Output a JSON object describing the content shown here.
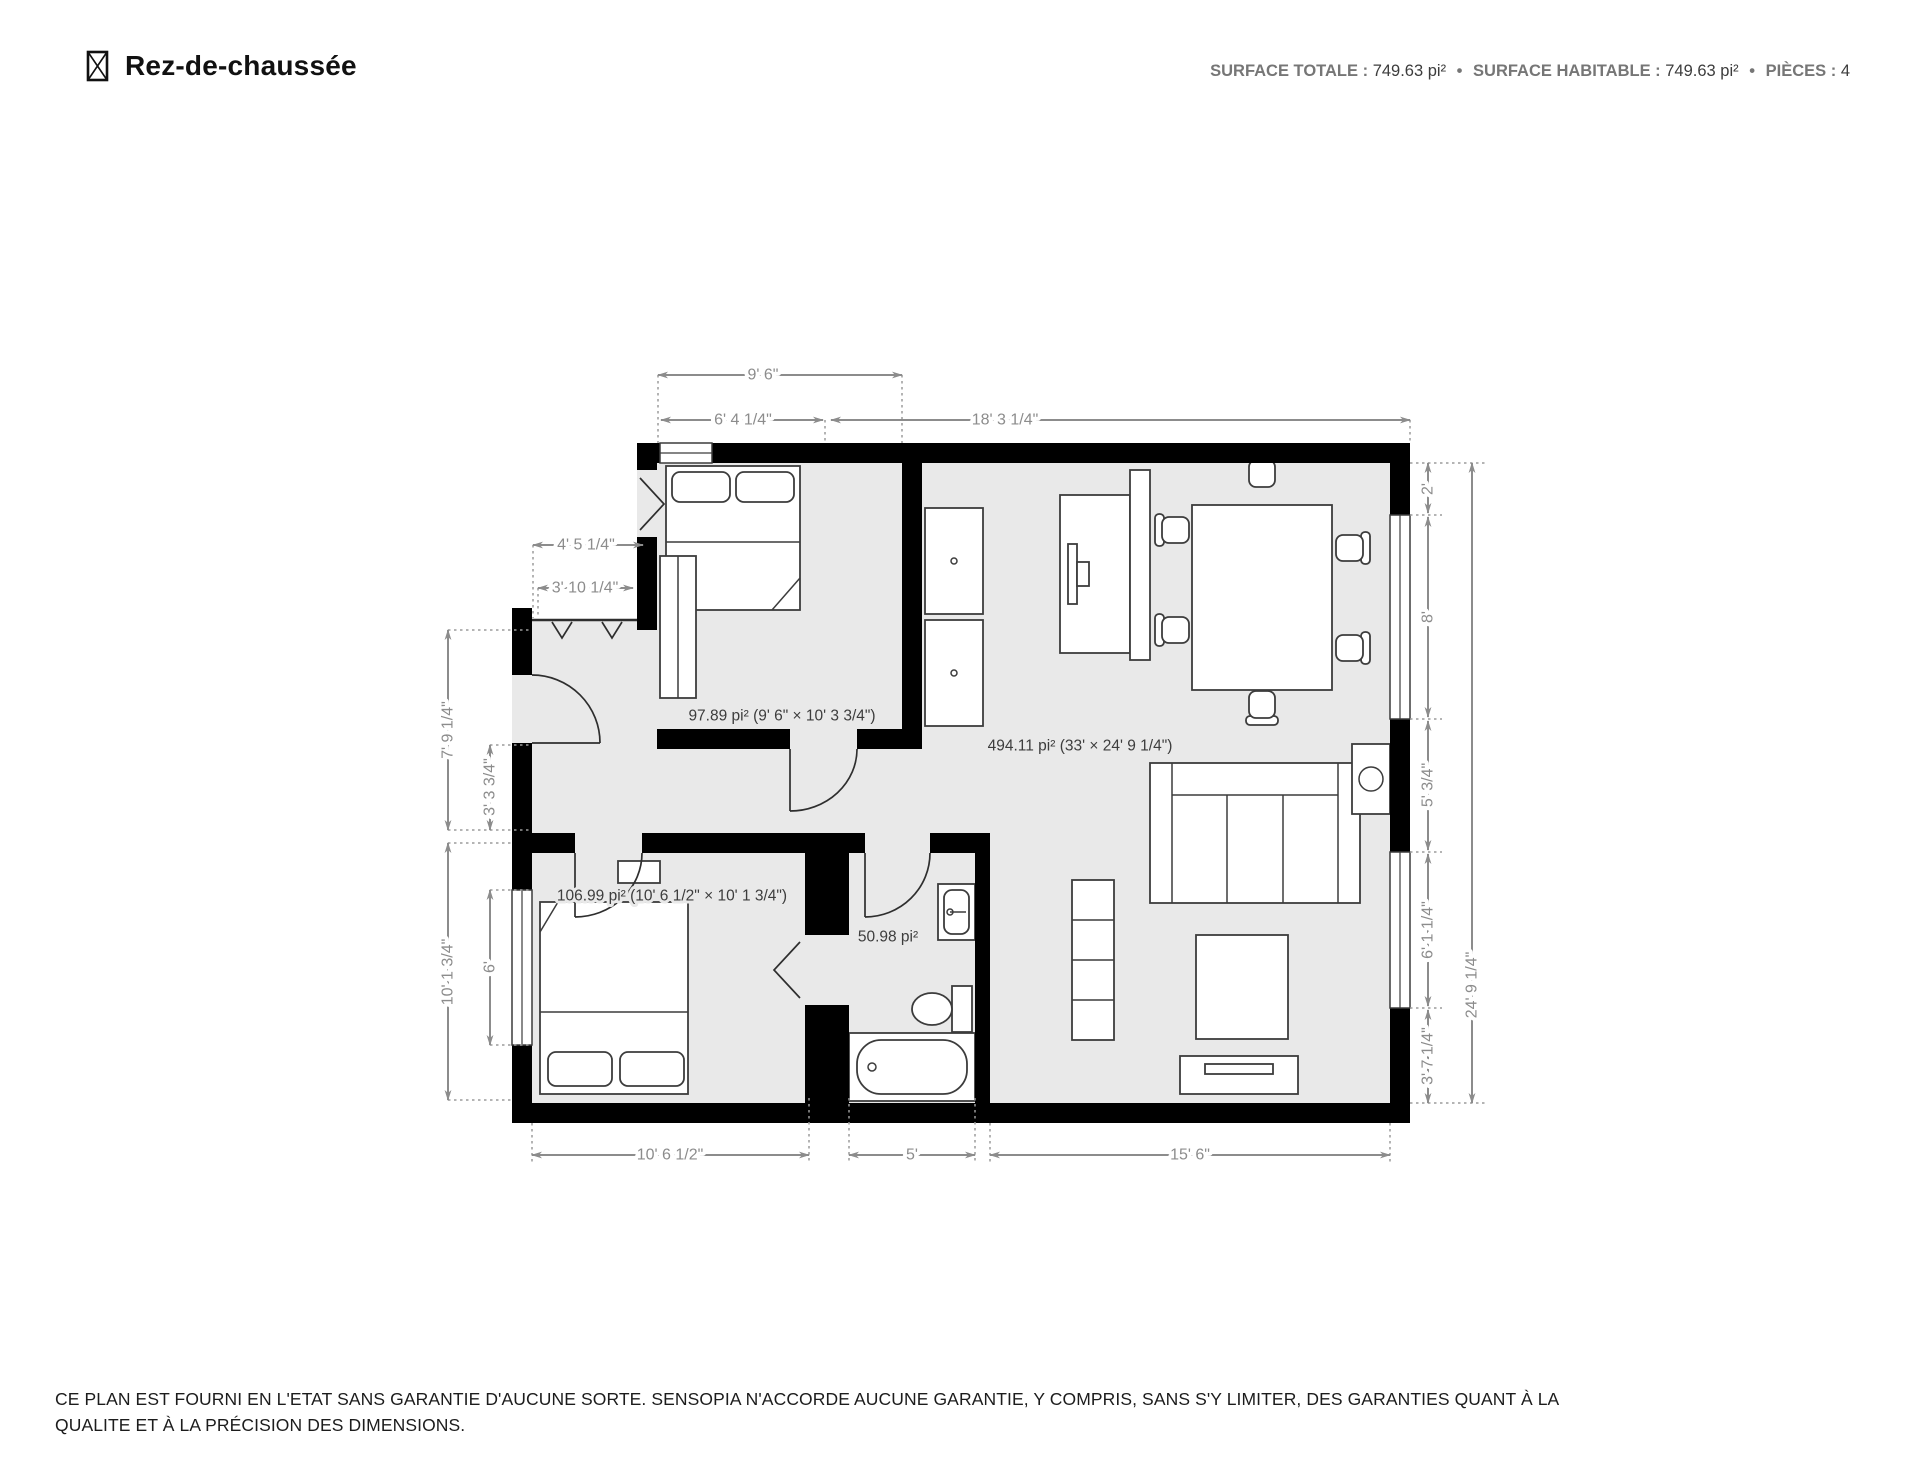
{
  "header": {
    "title": "Rez-de-chaussée",
    "stats": [
      {
        "label": "SURFACE TOTALE :",
        "value": "749.63 pi²"
      },
      {
        "label": "SURFACE HABITABLE :",
        "value": "749.63 pi²"
      },
      {
        "label": "PIÈCES :",
        "value": "4"
      }
    ],
    "separator": "•"
  },
  "plan": {
    "rooms": [
      {
        "id": "bedroom-1",
        "label": "97.89 pi² (9' 6\" × 10' 3 3/4\")"
      },
      {
        "id": "living-dining",
        "label": "494.11 pi² (33' × 24' 9 1/4\")"
      },
      {
        "id": "bedroom-2",
        "label": "106.99 pi² (10' 6 1/2\" × 10' 1 3/4\")"
      },
      {
        "id": "bathroom",
        "label": "50.98 pi²"
      }
    ],
    "dims": {
      "top": [
        "9' 6\"",
        "6' 4 1/4\"",
        "18' 3 1/4\""
      ],
      "left": [
        "4' 5 1/4\"",
        "3' 10 1/4\"",
        "7' 9 1/4\"",
        "3' 3 3/4\"",
        "10' 1 3/4\"",
        "6'"
      ],
      "right": [
        "2'",
        "8'",
        "5' 3/4\"",
        "6' 1 1/4\"",
        "3' 7 1/4\"",
        "24' 9 1/4\""
      ],
      "bottom": [
        "10' 6 1/2\"",
        "5'",
        "15' 6\""
      ]
    },
    "colors": {
      "wall": "#000000",
      "floor": "#e9e9e9",
      "dimension": "#8c8c8c",
      "room_label": "#3d3d3d",
      "furniture_stroke": "#3c3c3c"
    }
  },
  "footer": {
    "line1": "CE PLAN EST FOURNI EN L'ETAT SANS GARANTIE D'AUCUNE SORTE. SENSOPIA N'ACCORDE AUCUNE GARANTIE, Y COMPRIS, SANS S'Y LIMITER, DES GARANTIES QUANT À LA",
    "line2": "QUALITE ET À LA PRÉCISION DES DIMENSIONS."
  }
}
